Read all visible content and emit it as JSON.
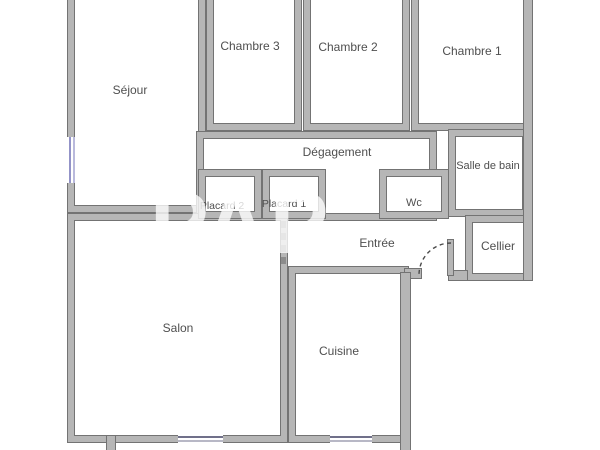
{
  "plan_title": "Apartment floor plan",
  "watermark": "PAP",
  "rooms": {
    "sejour": {
      "label": "Séjour"
    },
    "chambre3": {
      "label": "Chambre 3"
    },
    "chambre2": {
      "label": "Chambre 2"
    },
    "chambre1": {
      "label": "Chambre 1"
    },
    "degagement": {
      "label": "Dégagement"
    },
    "salle_de_bain": {
      "label": "Salle de bain"
    },
    "wc": {
      "label": "Wc"
    },
    "placard2": {
      "label": "Placard 2"
    },
    "placard1": {
      "label": "Placard 1"
    },
    "entree": {
      "label": "Entrée"
    },
    "cellier": {
      "label": "Cellier"
    },
    "salon": {
      "label": "Salon"
    },
    "cuisine": {
      "label": "Cuisine"
    }
  },
  "colors": {
    "wall_fill": "#b6b6b6",
    "wall_outline": "#737373",
    "window_marking": "#9393c8",
    "label_text": "#4f4f4f",
    "background": "#ffffff"
  },
  "features": {
    "entrance_door": "quarter-circle dashed swing arc with door leaf, bottom of Entrée",
    "open_passage": "dashed line between Salon and Entrée",
    "windows": [
      "Séjour left wall",
      "Salon bottom wall",
      "Cuisine bottom wall"
    ]
  }
}
